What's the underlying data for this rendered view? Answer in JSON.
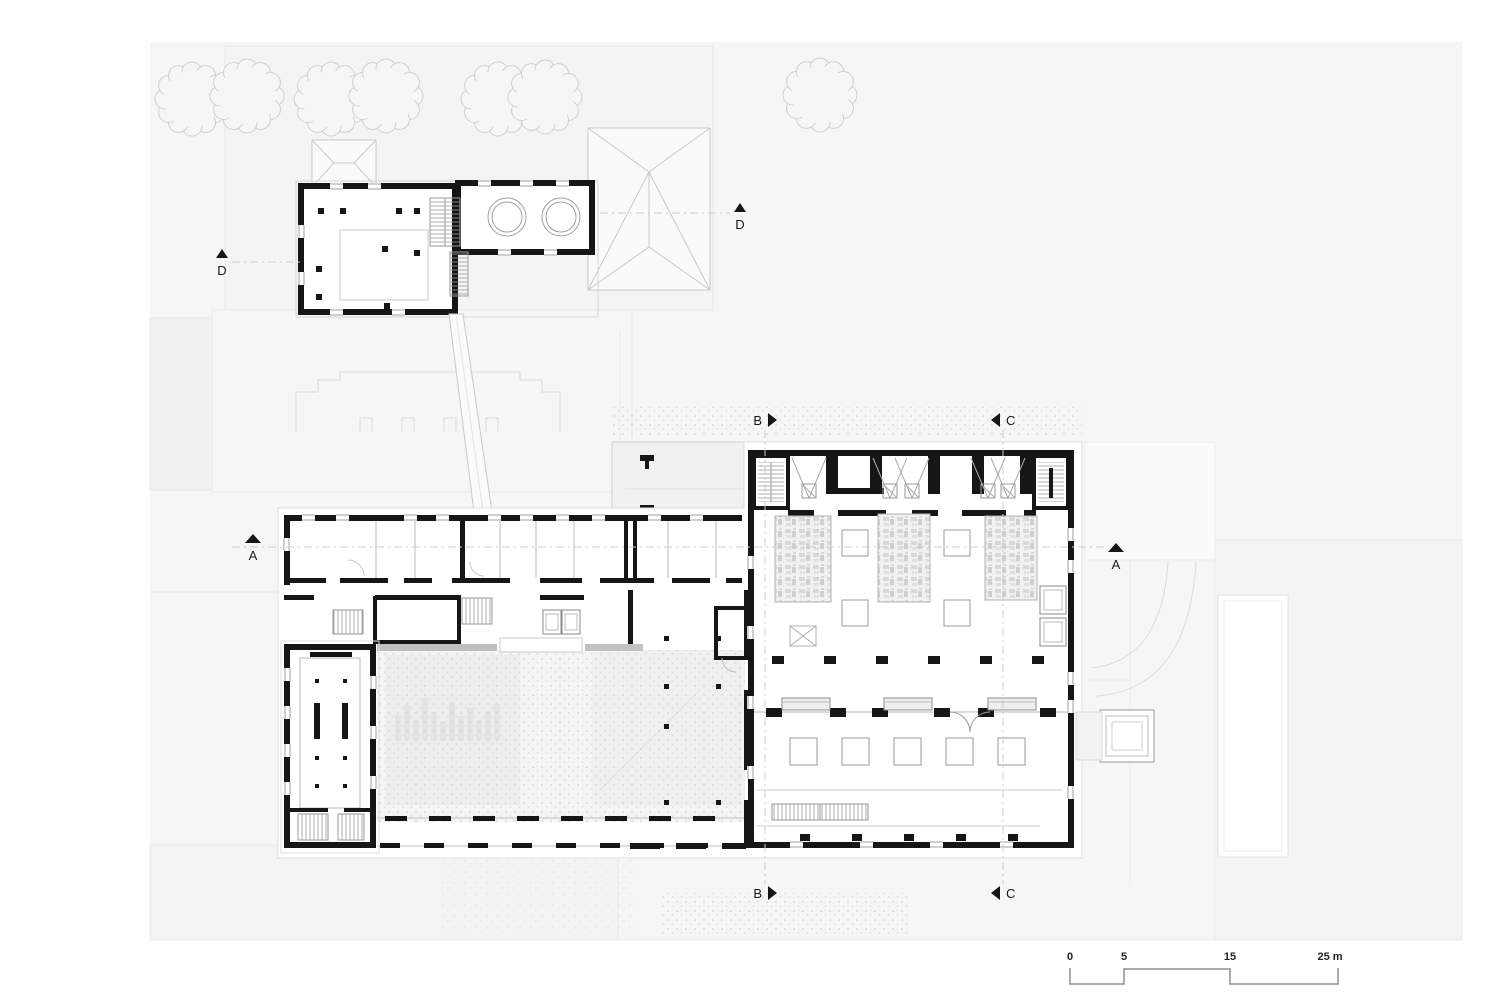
{
  "drawing": {
    "kind": "architectural site / ground floor plan",
    "building_elements": [
      "annex-building",
      "walkway",
      "office-wing",
      "tall-hall",
      "courtyard",
      "central-block",
      "exhibition-hall",
      "entrance-porch",
      "roofs",
      "trees",
      "pool"
    ]
  },
  "section_markers": {
    "a_left": {
      "label": "A"
    },
    "a_right": {
      "label": "A"
    },
    "b_top": {
      "label": "B"
    },
    "b_bottom": {
      "label": "B"
    },
    "c_top": {
      "label": "C"
    },
    "c_bottom": {
      "label": "C"
    },
    "d_left": {
      "label": "D"
    },
    "d_right": {
      "label": "D"
    }
  },
  "scale_bar": {
    "tick_0": "0",
    "tick_5": "5",
    "tick_15": "15",
    "tick_25": "25 m"
  },
  "colors": {
    "wall": "#161616",
    "site": "#f6f6f6",
    "panel": "#f2f2f2",
    "ghost": "#d9d9d9",
    "outline": "#c4c4c4",
    "thin": "#b9b9b9",
    "stipple": "#d6d6d6",
    "canopy": "#bfbfbf",
    "white": "#ffffff"
  }
}
